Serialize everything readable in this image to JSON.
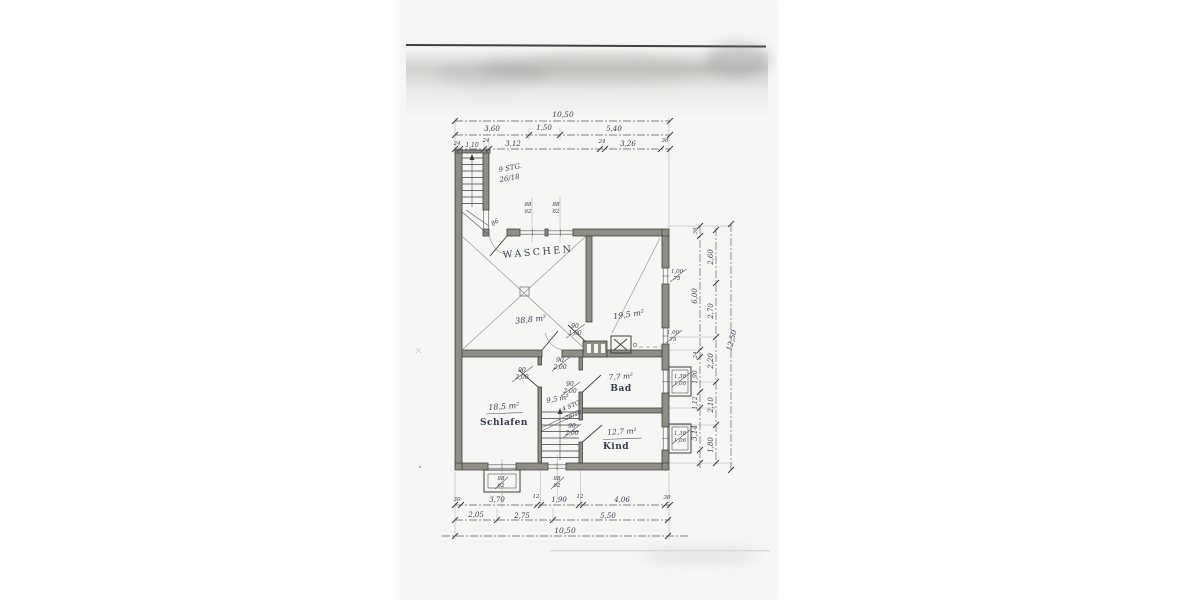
{
  "plan": {
    "rooms": {
      "waschen": {
        "name": "WASCHEN",
        "area": "38,8 m²"
      },
      "room_right": {
        "area": "19,5 m²"
      },
      "bad": {
        "name": "Bad",
        "area": "7,7 m²"
      },
      "flur": {
        "area": "9,5 m²"
      },
      "schlafen": {
        "name": "Schlafen",
        "area": "18,5 m²"
      },
      "kind": {
        "name": "Kind",
        "area": "12,7 m²"
      }
    },
    "stairs": {
      "exterior": {
        "line1": "9 STG.",
        "line2": "26/18"
      },
      "interior": {
        "line1": "4 STG",
        "line2": "26/18"
      }
    },
    "doors": {
      "entry": "86",
      "hall": {
        "w": "90",
        "h": "2,00"
      },
      "schlafen": {
        "w": "90",
        "h": "2,00"
      },
      "bad": {
        "w": "90",
        "h": "2,00"
      },
      "kind": {
        "w": "90",
        "h": "2,00"
      },
      "waschen_pass": {
        "w": "90",
        "h": "1,00"
      }
    },
    "windows": {
      "top1": {
        "w": "88",
        "h": "62"
      },
      "top2": {
        "w": "88",
        "h": "62"
      },
      "right1": {
        "w": "1,00",
        "h": "75"
      },
      "right2": {
        "w": "1,00",
        "h": "75"
      },
      "right3": {
        "w": "1,38",
        "h": "1,06"
      },
      "right4": {
        "w": "1,38",
        "h": "1,06"
      },
      "bottom1": {
        "w": "88",
        "h": "62"
      },
      "bottom2": {
        "w": "88",
        "h": "62"
      }
    },
    "dims": {
      "top_total": "10,50",
      "top_row2": [
        "3,60",
        "1,50",
        "5,40"
      ],
      "top_row3": [
        "24",
        "1,10",
        "24",
        "3,12",
        "24",
        "3,26",
        "36"
      ],
      "right_inner": [
        "36",
        "6,00",
        "24",
        "1,90",
        "1,12",
        "3,14"
      ],
      "right_middle": [
        "2,60",
        "2,70",
        "2,20",
        "2,10",
        "1,80"
      ],
      "right_total": "12,50",
      "bottom_row1": [
        "30",
        "3,70",
        "12",
        "1,90",
        "12",
        "4,06",
        "30"
      ],
      "bottom_row2": [
        "2,05",
        "2,75",
        "5,50"
      ],
      "bottom_total": "10,50"
    }
  }
}
